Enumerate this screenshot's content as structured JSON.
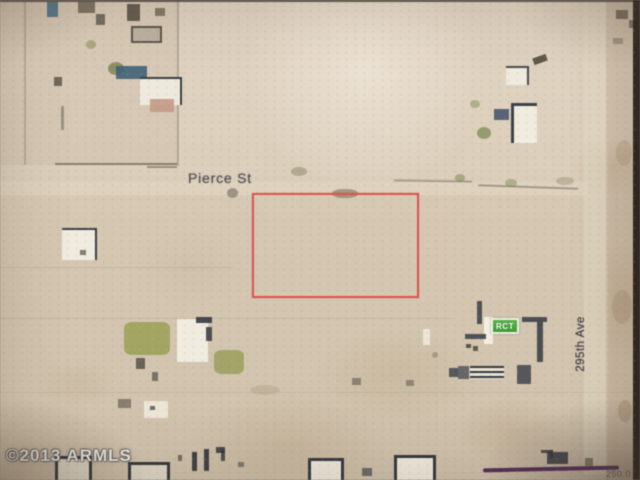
{
  "map": {
    "labels": {
      "street": "Pierce St",
      "avenue": "295th Ave",
      "marker": "RCT",
      "watermark": "©2013 ARMLS",
      "corner_measure": "250.0"
    },
    "colors": {
      "parcel_outline": "#df524e",
      "marker_green": "#47a437",
      "marker_border": "#eef0e8",
      "land_light": "#dccfbb",
      "land_dark": "#cfc1aa",
      "road_band": "#e3d9c5",
      "building_dark": "#3f444b",
      "building_white": "#f0ebdf",
      "vegetation_green": "#99a052",
      "boundary_line": "#6a6254",
      "annotation_purple": "#53265c",
      "label_text": "#4f4f56",
      "watermark_text": "#f2f0e8",
      "photo_edge": "#231e19"
    },
    "parcel": {
      "x": 252,
      "y": 193,
      "w": 163,
      "h": 101
    },
    "features": [
      {
        "n": "road-band-pierce-st",
        "x": 0,
        "y": 182,
        "w": 588,
        "h": 13,
        "bg": "#e4dac6",
        "op": 0.5
      },
      {
        "n": "road-band-295th-ave",
        "x": 584,
        "y": 0,
        "w": 24,
        "h": 474,
        "bg": "#e2d8c3",
        "op": 0.55
      },
      {
        "n": "ground-shading",
        "x": 606,
        "y": 0,
        "w": 28,
        "h": 480,
        "bg": "rgba(150,122,92,.18)"
      },
      {
        "n": "ground-shading",
        "x": 0,
        "y": 0,
        "w": 178,
        "h": 165,
        "bg": "rgba(160,140,110,.10)"
      },
      {
        "n": "boundary-line",
        "x": 55,
        "y": 163,
        "w": 122,
        "h": 2,
        "bg": "#5f5948",
        "op": 0.65
      },
      {
        "n": "boundary-line",
        "x": 147,
        "y": 166,
        "w": 30,
        "h": 2,
        "bg": "#5f5948",
        "op": 0.55
      },
      {
        "n": "boundary-line",
        "x": 394,
        "y": 180,
        "w": 78,
        "h": 2,
        "bg": "#6a6254",
        "op": 0.45,
        "rot": 1
      },
      {
        "n": "boundary-line",
        "x": 478,
        "y": 186,
        "w": 100,
        "h": 2,
        "bg": "#6a6254",
        "op": 0.5,
        "rot": 2
      },
      {
        "n": "boundary-line",
        "x": 24,
        "y": 2,
        "w": 2,
        "h": 163,
        "bg": "#6a6254",
        "op": 0.3
      },
      {
        "n": "boundary-line",
        "x": 177,
        "y": 0,
        "w": 2,
        "h": 166,
        "bg": "#6a6254",
        "op": 0.35
      },
      {
        "n": "boundary-line",
        "x": 0,
        "y": 267,
        "w": 232,
        "h": 1,
        "bg": "#6a6254",
        "op": 0.14
      },
      {
        "n": "boundary-line",
        "x": 0,
        "y": 318,
        "w": 452,
        "h": 1,
        "bg": "#6a6254",
        "op": 0.14
      },
      {
        "n": "boundary-line",
        "x": 0,
        "y": 392,
        "w": 640,
        "h": 1,
        "bg": "#6a6254",
        "op": 0.12
      },
      {
        "n": "building-dark",
        "x": 47,
        "y": 2,
        "w": 11,
        "h": 15,
        "bg": "#46718c",
        "op": 0.9
      },
      {
        "n": "building-dark",
        "x": 78,
        "y": 2,
        "w": 17,
        "h": 11,
        "bg": "#6e6557",
        "op": 0.85
      },
      {
        "n": "building-dark",
        "x": 96,
        "y": 14,
        "w": 9,
        "h": 11,
        "bg": "#5d564b",
        "op": 0.8
      },
      {
        "n": "building-dark",
        "x": 127,
        "y": 4,
        "w": 13,
        "h": 17,
        "bg": "#4f4a40",
        "op": 0.85
      },
      {
        "n": "building-dark",
        "x": 155,
        "y": 8,
        "w": 10,
        "h": 8,
        "bg": "#5d564b",
        "op": 0.7
      },
      {
        "n": "building-outlined",
        "x": 131,
        "y": 26,
        "w": 27,
        "h": 13,
        "bg": "#b9b09d",
        "bd": "2px solid #4f4a40",
        "op": 0.9
      },
      {
        "n": "tree",
        "x": 108,
        "y": 62,
        "w": 16,
        "h": 13,
        "bg": "#7e8655",
        "op": 0.85,
        "rad": "50%"
      },
      {
        "n": "tree",
        "x": 86,
        "y": 40,
        "w": 10,
        "h": 9,
        "bg": "#8d9161",
        "op": 0.6,
        "rad": "50%"
      },
      {
        "n": "building-dark",
        "x": 116,
        "y": 66,
        "w": 31,
        "h": 13,
        "bg": "#3e6277",
        "op": 0.9
      },
      {
        "n": "building-white",
        "x": 140,
        "y": 77,
        "w": 40,
        "h": 26,
        "bg": "#eee9dd",
        "bt": "2px solid #3a3f45",
        "br": "2px solid #3a3f45"
      },
      {
        "n": "building-roof",
        "x": 150,
        "y": 99,
        "w": 24,
        "h": 13,
        "bg": "#c49a84",
        "op": 0.9
      },
      {
        "n": "building-dark",
        "x": 54,
        "y": 77,
        "w": 8,
        "h": 9,
        "bg": "#55504a",
        "op": 0.8
      },
      {
        "n": "fence-line",
        "x": 61,
        "y": 106,
        "w": 3,
        "h": 24,
        "bg": "#6a6254",
        "op": 0.55
      },
      {
        "n": "ground-smudge",
        "x": 227,
        "y": 188,
        "w": 11,
        "h": 10,
        "bg": "#5d564b",
        "op": 0.5,
        "rad": "50%"
      },
      {
        "n": "ground-smudge",
        "x": 291,
        "y": 167,
        "w": 16,
        "h": 9,
        "bg": "#7d7a5e",
        "op": 0.45,
        "rad": "50%"
      },
      {
        "n": "ground-smudge",
        "x": 332,
        "y": 189,
        "w": 26,
        "h": 9,
        "bg": "#6b5f48",
        "op": 0.5,
        "rad": "45%"
      },
      {
        "n": "vegetation",
        "x": 455,
        "y": 174,
        "w": 10,
        "h": 8,
        "bg": "#7f8a55",
        "op": 0.55,
        "rad": "50%"
      },
      {
        "n": "vegetation",
        "x": 505,
        "y": 179,
        "w": 12,
        "h": 8,
        "bg": "#7f8a55",
        "op": 0.5,
        "rad": "50%"
      },
      {
        "n": "ground-smudge",
        "x": 556,
        "y": 177,
        "w": 18,
        "h": 8,
        "bg": "#8a7a5e",
        "op": 0.35,
        "rad": "50%"
      },
      {
        "n": "building-white",
        "x": 506,
        "y": 66,
        "w": 21,
        "h": 17,
        "bg": "#efeade",
        "bt": "2px solid #474c52",
        "br": "2px solid #474c52"
      },
      {
        "n": "building-white",
        "x": 511,
        "y": 103,
        "w": 23,
        "h": 37,
        "bg": "#f1ece0",
        "bt": "3px solid #3d424a",
        "bl": "3px solid #3d424a"
      },
      {
        "n": "building-dark",
        "x": 494,
        "y": 109,
        "w": 15,
        "h": 11,
        "bg": "#41506b",
        "op": 0.85
      },
      {
        "n": "vegetation",
        "x": 477,
        "y": 127,
        "w": 14,
        "h": 12,
        "bg": "#7f8a55",
        "op": 0.75,
        "rad": "50%"
      },
      {
        "n": "vegetation",
        "x": 470,
        "y": 100,
        "w": 10,
        "h": 8,
        "bg": "#8d9161",
        "op": 0.55,
        "rad": "50%"
      },
      {
        "n": "building-dark",
        "x": 533,
        "y": 56,
        "w": 14,
        "h": 7,
        "bg": "#4a4438",
        "op": 0.85,
        "rot": -20
      },
      {
        "n": "building-dark",
        "x": 616,
        "y": 10,
        "w": 12,
        "h": 9,
        "bg": "#5d564b",
        "op": 0.75
      },
      {
        "n": "building-dark",
        "x": 629,
        "y": 20,
        "w": 8,
        "h": 8,
        "bg": "#55504a",
        "op": 0.65
      },
      {
        "n": "ground-smudge",
        "x": 613,
        "y": 38,
        "w": 10,
        "h": 6,
        "bg": "#6a6254",
        "op": 0.45
      },
      {
        "n": "ground-smudge",
        "x": 616,
        "y": 140,
        "w": 16,
        "h": 26,
        "bg": "#9a7e5e",
        "op": 0.25,
        "rad": "50%"
      },
      {
        "n": "ground-smudge",
        "x": 612,
        "y": 290,
        "w": 20,
        "h": 34,
        "bg": "#96795a",
        "op": 0.25,
        "rad": "50%"
      },
      {
        "n": "ground-smudge",
        "x": 618,
        "y": 400,
        "w": 14,
        "h": 22,
        "bg": "#8f734f",
        "op": 0.3,
        "rad": "50%"
      },
      {
        "n": "building-white",
        "x": 62,
        "y": 228,
        "w": 33,
        "h": 30,
        "bg": "#f0ebdf",
        "bt": "2px solid #3a3f45",
        "br": "2px solid #3a3f45"
      },
      {
        "n": "building-dark",
        "x": 80,
        "y": 250,
        "w": 6,
        "h": 5,
        "bg": "#55504a",
        "op": 0.7
      },
      {
        "n": "vegetation",
        "x": 124,
        "y": 322,
        "w": 46,
        "h": 33,
        "bg": "#99a052",
        "op": 0.85,
        "rad": "18%"
      },
      {
        "n": "building-white",
        "x": 177,
        "y": 319,
        "w": 31,
        "h": 43,
        "bg": "#f0ece0"
      },
      {
        "n": "building-dark",
        "x": 196,
        "y": 317,
        "w": 16,
        "h": 6,
        "bg": "#33383f",
        "op": 0.9
      },
      {
        "n": "building-dark",
        "x": 206,
        "y": 327,
        "w": 6,
        "h": 14,
        "bg": "#33383f",
        "op": 0.85
      },
      {
        "n": "vegetation",
        "x": 214,
        "y": 350,
        "w": 30,
        "h": 24,
        "bg": "#93994f",
        "op": 0.75,
        "rad": "25%"
      },
      {
        "n": "building-dark",
        "x": 136,
        "y": 358,
        "w": 9,
        "h": 11,
        "bg": "#4f4a42",
        "op": 0.8
      },
      {
        "n": "building-dark",
        "x": 152,
        "y": 372,
        "w": 6,
        "h": 9,
        "bg": "#55504a",
        "op": 0.7
      },
      {
        "n": "building-white",
        "x": 144,
        "y": 401,
        "w": 24,
        "h": 17,
        "bg": "#efe9da",
        "op": 0.9
      },
      {
        "n": "building-dark",
        "x": 150,
        "y": 406,
        "w": 5,
        "h": 4,
        "bg": "#4a4f56",
        "op": 0.8
      },
      {
        "n": "building-dark",
        "x": 118,
        "y": 399,
        "w": 13,
        "h": 9,
        "bg": "#565046",
        "op": 0.6
      },
      {
        "n": "ground-smudge",
        "x": 250,
        "y": 385,
        "w": 30,
        "h": 10,
        "bg": "#8a7a5e",
        "op": 0.2,
        "rad": "50%"
      },
      {
        "n": "building-dark",
        "x": 352,
        "y": 378,
        "w": 9,
        "h": 7,
        "bg": "#565046",
        "op": 0.55
      },
      {
        "n": "building-dark",
        "x": 406,
        "y": 380,
        "w": 8,
        "h": 6,
        "bg": "#565046",
        "op": 0.5
      },
      {
        "n": "building-dark",
        "x": 477,
        "y": 301,
        "w": 5,
        "h": 23,
        "bg": "#3f444b",
        "op": 0.9
      },
      {
        "n": "building-white",
        "x": 484,
        "y": 317,
        "w": 9,
        "h": 27,
        "bg": "#f2eee2"
      },
      {
        "n": "building-dark",
        "x": 465,
        "y": 334,
        "w": 21,
        "h": 5,
        "bg": "#3f444b",
        "op": 0.9
      },
      {
        "n": "building-dark",
        "x": 466,
        "y": 344,
        "w": 5,
        "h": 4,
        "bg": "#474239",
        "op": 0.85
      },
      {
        "n": "building-dark",
        "x": 473,
        "y": 346,
        "w": 5,
        "h": 5,
        "bg": "#474239",
        "op": 0.8
      },
      {
        "n": "building-dark",
        "x": 522,
        "y": 317,
        "w": 25,
        "h": 5,
        "bg": "#3c4148",
        "op": 0.9
      },
      {
        "n": "building-dark",
        "x": 537,
        "y": 322,
        "w": 6,
        "h": 40,
        "bg": "#3c4148",
        "op": 0.9
      },
      {
        "n": "building-white",
        "x": 423,
        "y": 329,
        "w": 7,
        "h": 16,
        "bg": "#eee9dd",
        "op": 0.9
      },
      {
        "n": "building-dark",
        "x": 449,
        "y": 368,
        "w": 9,
        "h": 9,
        "bg": "#40454c",
        "op": 0.85
      },
      {
        "n": "building-dark",
        "x": 458,
        "y": 366,
        "w": 11,
        "h": 13,
        "bg": "#4a4f56",
        "op": 0.8
      },
      {
        "n": "building-striped",
        "x": 470,
        "y": 366,
        "w": 34,
        "h": 13,
        "stripes": true
      },
      {
        "n": "building-dark",
        "x": 517,
        "y": 365,
        "w": 14,
        "h": 19,
        "bg": "#3f444b",
        "op": 0.85
      },
      {
        "n": "ground-smudge",
        "x": 432,
        "y": 352,
        "w": 6,
        "h": 6,
        "bg": "#6a6254",
        "op": 0.4,
        "rad": "50%"
      },
      {
        "n": "building-outlined",
        "x": 55,
        "y": 456,
        "w": 31,
        "h": 24,
        "bg": "#e6dfcd",
        "bd": "3px solid #33383f"
      },
      {
        "n": "building-outlined",
        "x": 128,
        "y": 462,
        "w": 36,
        "h": 18,
        "bg": "#ddd6c4",
        "bd": "3px solid #33383f"
      },
      {
        "n": "building-dark",
        "x": 192,
        "y": 452,
        "w": 5,
        "h": 19,
        "bg": "#2f343b",
        "op": 0.9
      },
      {
        "n": "building-dark",
        "x": 204,
        "y": 449,
        "w": 5,
        "h": 22,
        "bg": "#2f343b",
        "op": 0.9
      },
      {
        "n": "building-dark",
        "x": 216,
        "y": 447,
        "w": 9,
        "h": 6,
        "bg": "#2f343b",
        "op": 0.85
      },
      {
        "n": "building-dark",
        "x": 221,
        "y": 450,
        "w": 4,
        "h": 11,
        "bg": "#2f343b",
        "op": 0.8
      },
      {
        "n": "building-dark",
        "x": 178,
        "y": 455,
        "w": 4,
        "h": 6,
        "bg": "#2f343b",
        "op": 0.6
      },
      {
        "n": "building-dark",
        "x": 238,
        "y": 462,
        "w": 6,
        "h": 5,
        "bg": "#2f343b",
        "op": 0.5
      },
      {
        "n": "building-outlined",
        "x": 308,
        "y": 458,
        "w": 30,
        "h": 22,
        "bg": "#eee8da",
        "bd": "3px solid #33383f"
      },
      {
        "n": "building-outlined",
        "x": 394,
        "y": 455,
        "w": 36,
        "h": 25,
        "bg": "#f0eadc",
        "bd": "3px solid #33383f"
      },
      {
        "n": "building-dark",
        "x": 362,
        "y": 468,
        "w": 10,
        "h": 8,
        "bg": "#4a4f56",
        "op": 0.75
      },
      {
        "n": "building-dark",
        "x": 547,
        "y": 452,
        "w": 21,
        "h": 12,
        "bg": "#3c4148",
        "op": 0.9
      },
      {
        "n": "building-dark",
        "x": 585,
        "y": 458,
        "w": 8,
        "h": 8,
        "bg": "#4a4438",
        "op": 0.55
      },
      {
        "n": "annotation-mark",
        "x": 541,
        "y": 450,
        "w": 12,
        "h": 3,
        "bg": "#3c3640",
        "op": 0.85
      },
      {
        "n": "annotation-mark",
        "x": 550,
        "y": 450,
        "w": 3,
        "h": 8,
        "bg": "#3c3640",
        "op": 0.8
      },
      {
        "n": "photo-edge-top",
        "x": 0,
        "y": 0,
        "w": 640,
        "h": 2,
        "bg": "#3a332c",
        "op": 0.75
      },
      {
        "n": "photo-edge-right",
        "x": 633,
        "y": 0,
        "w": 7,
        "h": 480,
        "bg": "#231e19",
        "op": 0.95
      }
    ]
  }
}
